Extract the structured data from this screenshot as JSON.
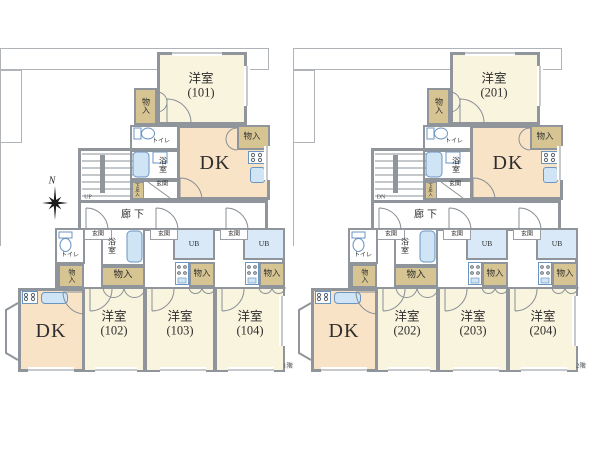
{
  "colors": {
    "wall": "#8f959b",
    "line": "#8a9096",
    "room_western": "#f8f4de",
    "room_dk": "#f9e3c7",
    "closet": "#d6c493",
    "wet_area": "#d9e9f7",
    "fixture_fill": "#cfe4f5",
    "fixture_stroke": "#6b95c1",
    "text": "#2e2e2e"
  },
  "labels": {
    "western": "洋室",
    "dk": "DK",
    "closet": "物入",
    "toilet": "トイレ",
    "bath": "浴室",
    "entrance": "玄関",
    "unit_bath": "UB",
    "corridor": "廊下",
    "shoe_box": "下足入",
    "north": "N"
  },
  "plans": [
    {
      "floor": "1階",
      "stairs": "UP",
      "top_unit": "(101)",
      "units": [
        "(102)",
        "(103)",
        "(104)"
      ],
      "has_compass": true
    },
    {
      "floor": "2階",
      "stairs": "DN",
      "top_unit": "(201)",
      "units": [
        "(202)",
        "(203)",
        "(204)"
      ],
      "has_compass": false
    }
  ]
}
